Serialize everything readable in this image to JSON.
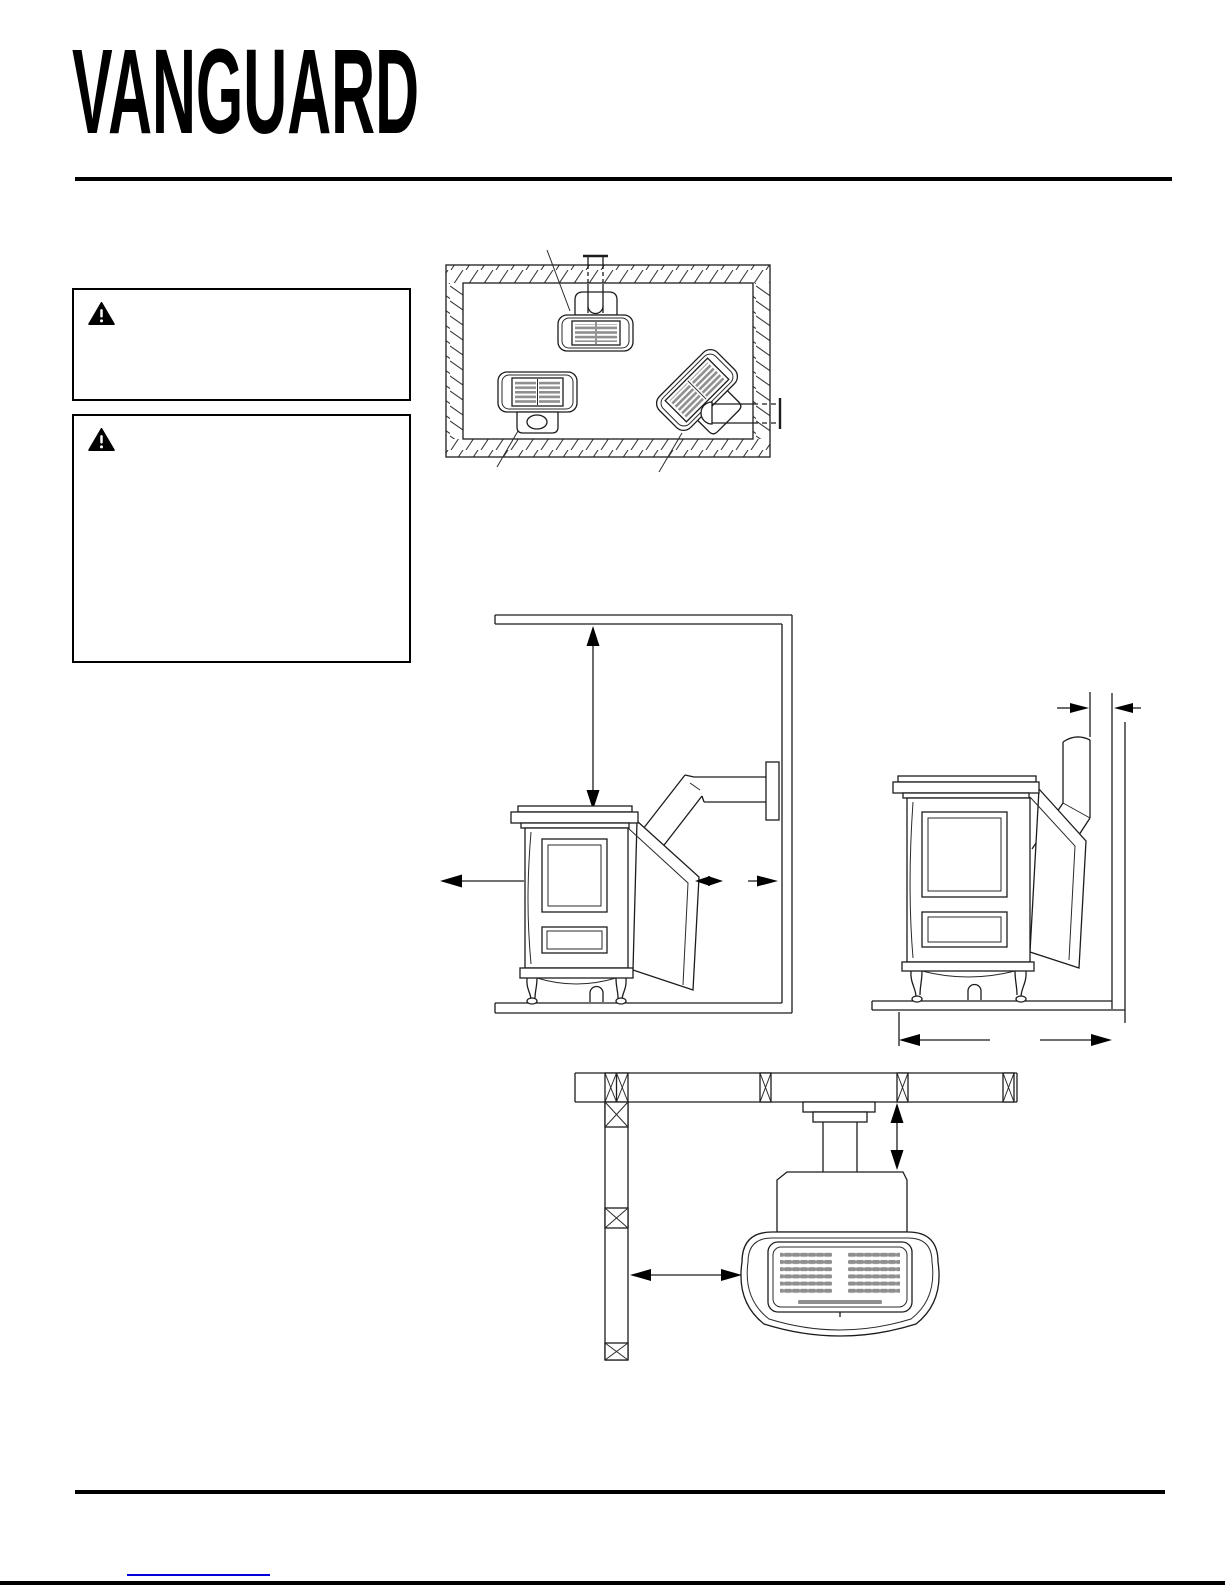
{
  "page": {
    "background": "#ffffff",
    "ink": "#1c1c1c",
    "link_color": "#0000dd"
  },
  "header": {
    "logo_text": "VANGUARD"
  },
  "warning_boxes": [
    {
      "icon": "warning-triangle-icon",
      "body_text": ""
    },
    {
      "icon": "warning-triangle-icon",
      "body_text": ""
    }
  ],
  "figures": [
    {
      "id": "room-plan-vent-options",
      "kind": "technical-line-drawing"
    },
    {
      "id": "side-view-ceiling-wall-clearances",
      "kind": "technical-line-drawing"
    },
    {
      "id": "side-view-vertical-vent-clearances",
      "kind": "technical-line-drawing"
    },
    {
      "id": "top-view-wall-clearances",
      "kind": "technical-line-drawing"
    }
  ],
  "footer": {
    "link_text": ""
  }
}
